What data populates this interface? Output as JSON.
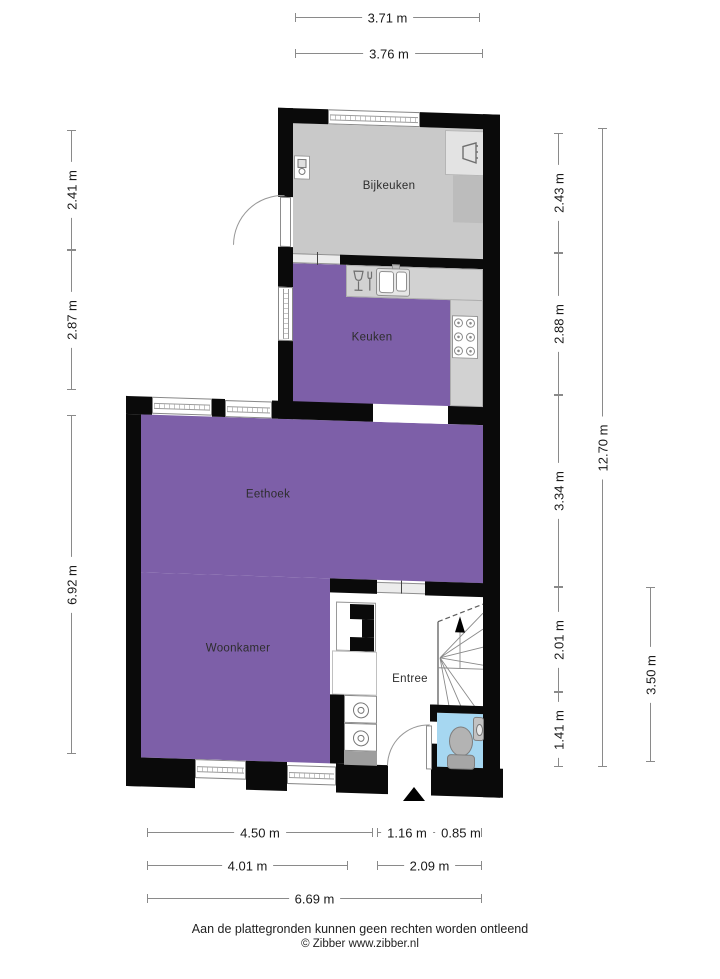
{
  "page": {
    "footer_line1": "Aan de plattegronden kunnen geen rechten worden ontleend",
    "footer_line2": "© Zibber www.zibber.nl"
  },
  "rooms": [
    {
      "name": "Bijkeuken"
    },
    {
      "name": "Keuken"
    },
    {
      "name": "Eethoek"
    },
    {
      "name": "Woonkamer"
    },
    {
      "name": "Entree"
    }
  ],
  "dims": {
    "top": [
      "3.71 m",
      "3.76 m"
    ],
    "left": [
      "2.41 m",
      "2.87 m",
      "6.92 m"
    ],
    "right": [
      "2.43 m",
      "2.88 m",
      "3.34 m",
      "2.01 m",
      "1.41 m"
    ],
    "right_total": "12.70 m",
    "right_partial": "3.50 m",
    "bottom_row1": [
      "4.50 m",
      "1.16 m",
      "0.85 m"
    ],
    "bottom_row2": [
      "4.01 m",
      "2.09 m"
    ],
    "bottom_row3": [
      "6.69 m"
    ]
  },
  "colors": {
    "floor_purple": "#7D5FA8",
    "floor_gray": "#C9C9C9",
    "counter_gray": "#D2D2D2",
    "toilet_blue": "#A6D7F1",
    "wall_black": "#0A0A0A",
    "dim_line": "#8A8A8A"
  },
  "icons": {
    "boiler": "boiler-icon",
    "sink": "sink-icon",
    "dishwasher": "dishwasher-icon",
    "kitchen_sink": "kitchen-sink-icon",
    "stove": "stove-icon",
    "washer": "washer-icon",
    "stairs": "stairs-icon",
    "toilet": "toilet-icon",
    "hand_basin": "hand-basin-icon",
    "entrance_arrow": "entrance-arrow-icon"
  }
}
